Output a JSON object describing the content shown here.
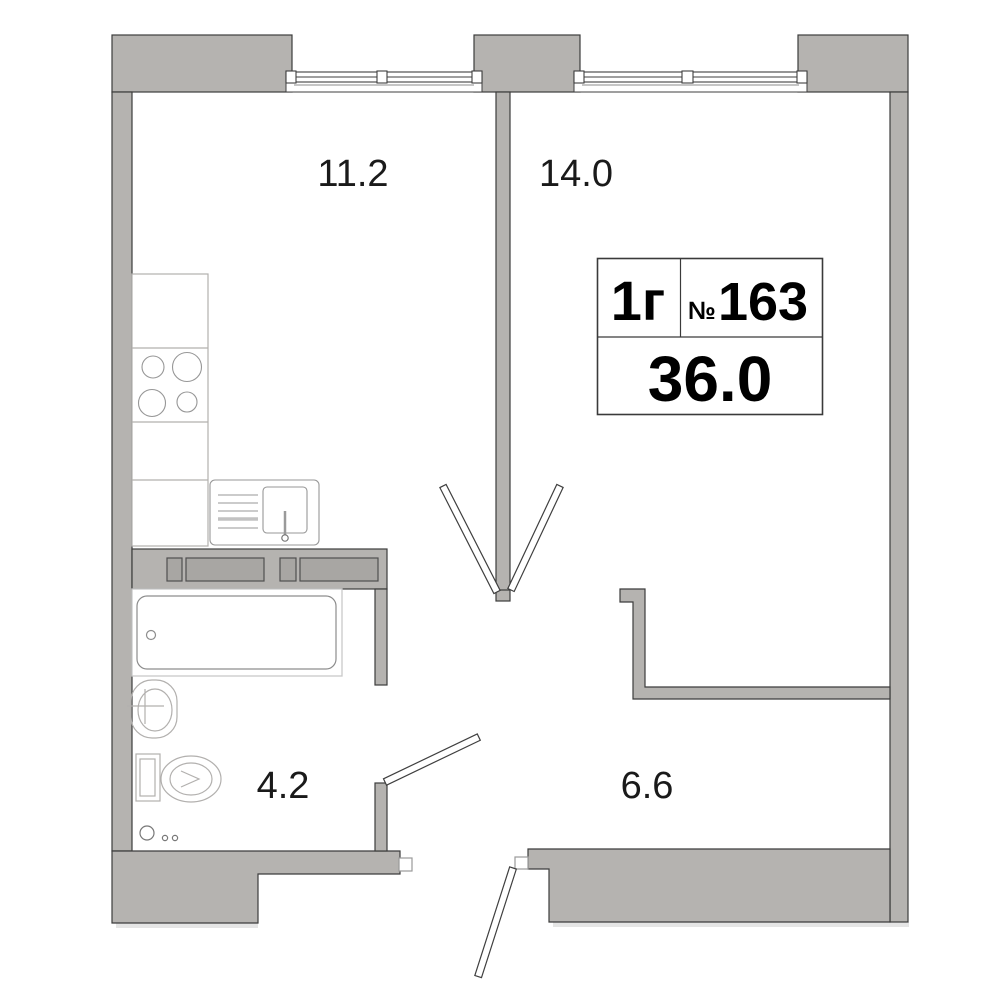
{
  "title": "Apartment floor plan",
  "unit_card": {
    "type_label": "1г",
    "number_sign": "№",
    "number": "163",
    "total_area": "36.0"
  },
  "rooms": {
    "kitchen": {
      "area": "11.2"
    },
    "living_room": {
      "area": "14.0"
    },
    "bathroom": {
      "area": "4.2"
    },
    "hallway": {
      "area": "6.6"
    }
  },
  "icons": {
    "stove": "stove-burners-icon",
    "kitchen_sink": "kitchen-sink-icon",
    "bathtub": "bathtub-icon",
    "washbasin": "washbasin-icon",
    "toilet": "toilet-icon",
    "floor_drain": "floor-drain-icon"
  },
  "colors": {
    "wall_fill": "#b5b3b0",
    "wall_outline": "#3c3c3c",
    "shaft_fill": "#a8a6a3",
    "fixture_outline": "#b2b0ae",
    "label_text": "#1a1a1a",
    "card_text": "#000000",
    "background": "#ffffff"
  }
}
